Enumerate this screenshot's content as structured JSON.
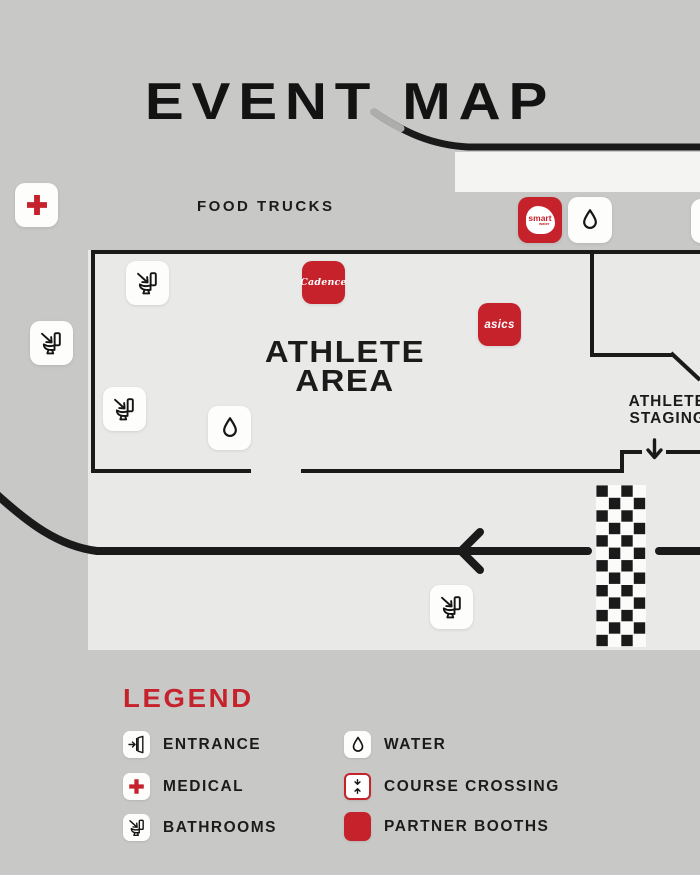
{
  "title": "EVENT MAP",
  "colors": {
    "brand_red": "#c5222c",
    "background_gray": "#c8c8c6",
    "map_gray": "#e9e9e7",
    "course_white": "#f4f4f2",
    "line_black": "#1a1a1a"
  },
  "map": {
    "food_trucks_label": "FOOD TRUCKS",
    "athlete_area": {
      "line1": "ATHLETE",
      "line2": "AREA"
    },
    "athlete_staging": {
      "line1": "ATHLETE",
      "line2": "STAGING"
    },
    "booths": {
      "smartwater": {
        "name": "smart",
        "subname": "water"
      },
      "cadence": {
        "name": "Cadence"
      },
      "asics": {
        "name": "asics"
      }
    }
  },
  "legend": {
    "title": "LEGEND",
    "items": [
      {
        "icon": "entrance-icon",
        "label": "ENTRANCE"
      },
      {
        "icon": "medical-icon",
        "label": "MEDICAL"
      },
      {
        "icon": "bathroom-icon",
        "label": "BATHROOMS"
      },
      {
        "icon": "water-icon",
        "label": "WATER"
      },
      {
        "icon": "course-crossing-icon",
        "label": "COURSE CROSSING"
      },
      {
        "icon": "partner-booth-icon",
        "label": "PARTNER BOOTHS"
      }
    ]
  }
}
